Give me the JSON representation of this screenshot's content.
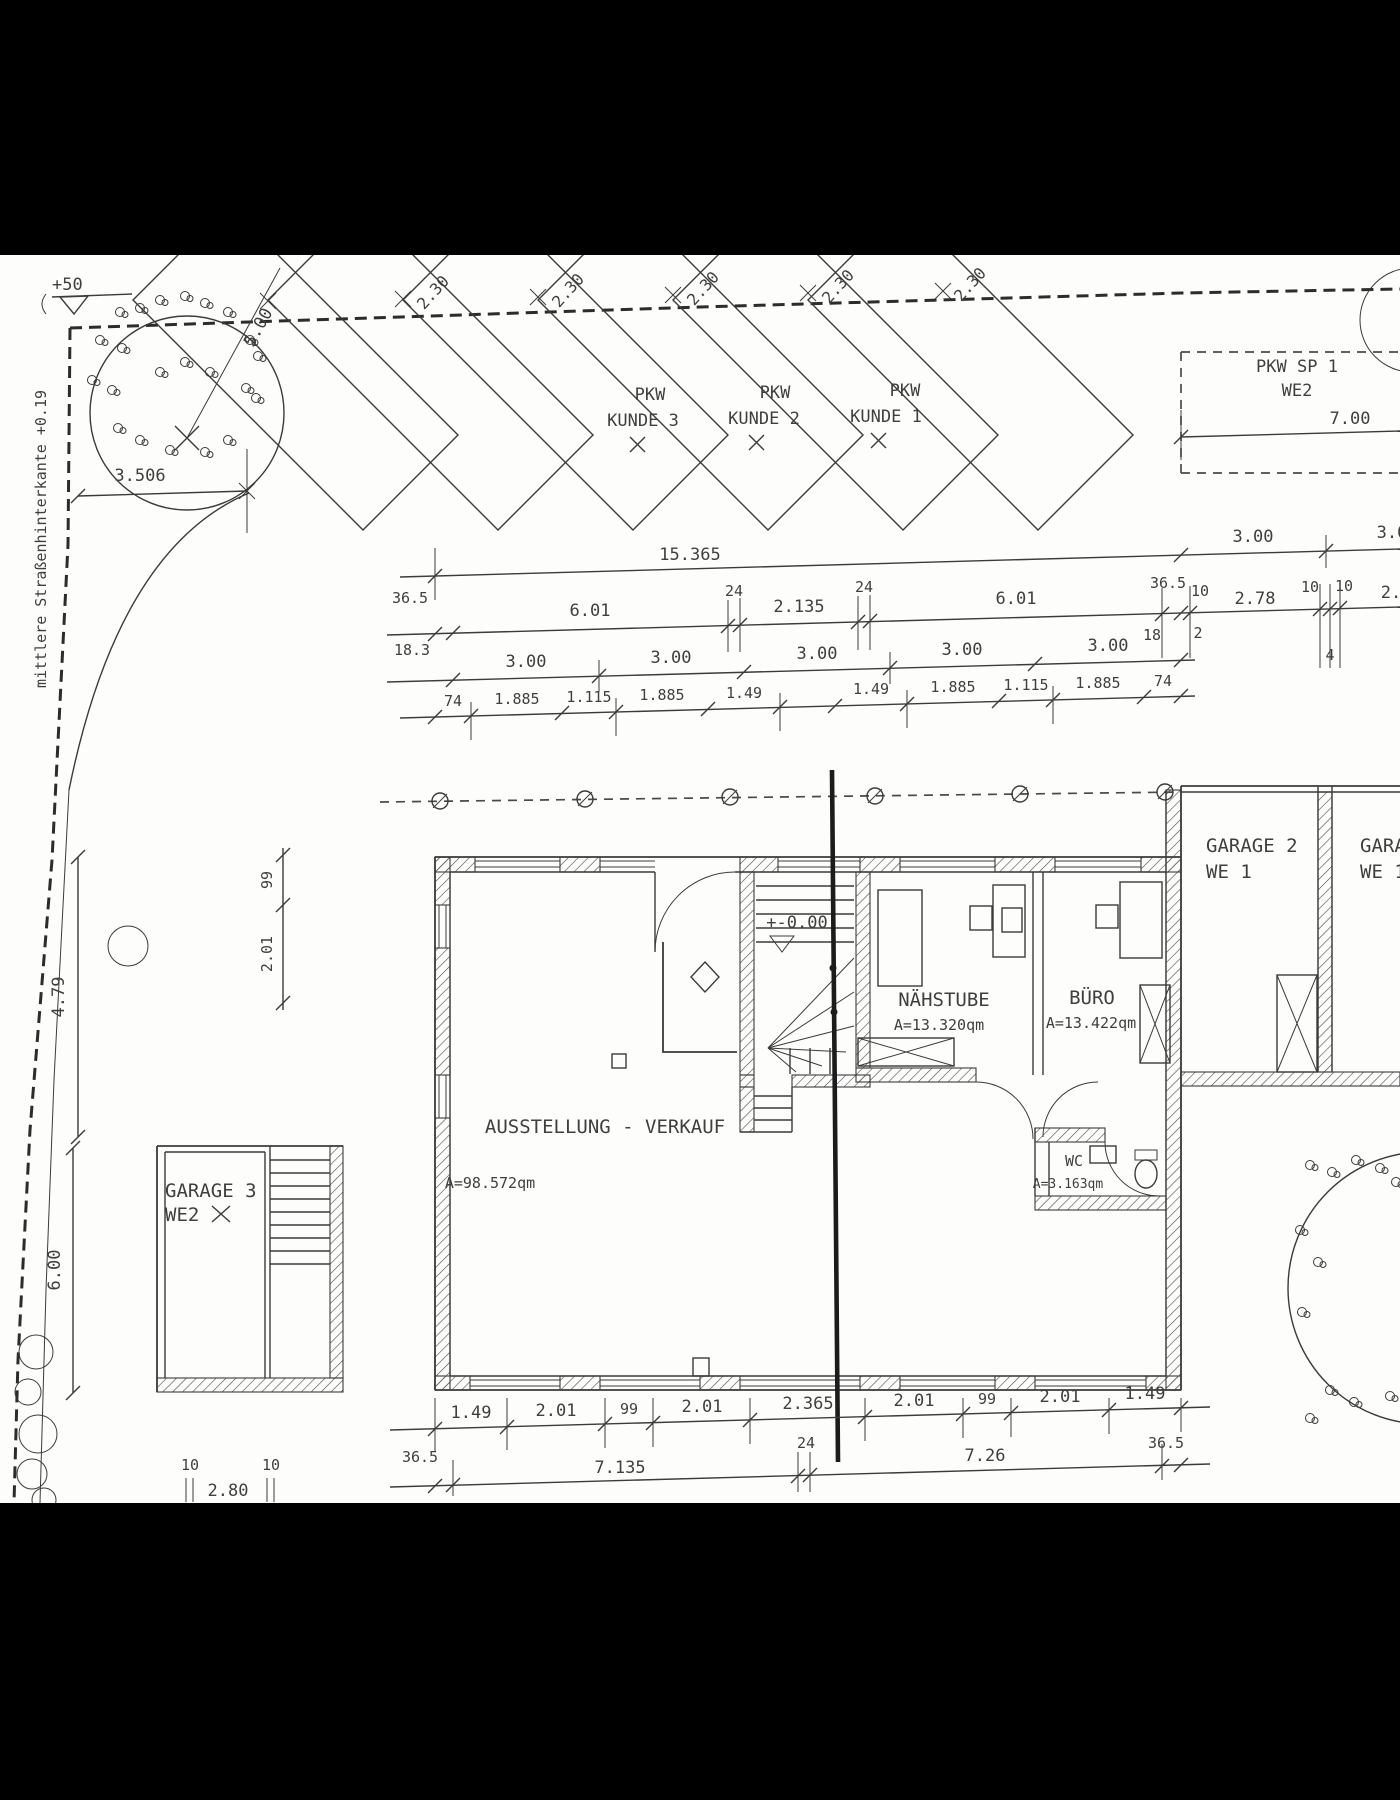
{
  "colors": {
    "paper": "#fdfdfc",
    "ink": "#3b3b3b",
    "bar": "#000000"
  },
  "site": {
    "street_note": "mittlere Straßenhinterkante +0.19",
    "benchmark_label": "+50",
    "tree_radius_dim": "5.00",
    "tree_offset_dim": "3.506",
    "stall_width_dim": "2.30",
    "parking_stalls": [
      {
        "type": "PKW",
        "name": "KUNDE 3"
      },
      {
        "type": "PKW",
        "name": "KUNDE 2"
      },
      {
        "type": "PKW",
        "name": "KUNDE 1"
      }
    ],
    "carport": {
      "name": "PKW SP 1",
      "unit": "WE2",
      "width_dim": "7.00"
    }
  },
  "building": {
    "level_label": "+-0.00",
    "rooms": [
      {
        "name": "AUSSTELLUNG - VERKAUF",
        "area": "A=98.572qm"
      },
      {
        "name": "NÄHSTUBE",
        "area": "A=13.320qm"
      },
      {
        "name": "BÜRO",
        "area": "A=13.422qm"
      },
      {
        "name": "WC",
        "area": "A=3.163qm"
      }
    ]
  },
  "garages": [
    {
      "name": "GARAGE 3",
      "unit": "WE2"
    },
    {
      "name": "GARAGE 2",
      "unit": "WE 1"
    },
    {
      "name": "GARA",
      "unit": "WE 1"
    }
  ],
  "dims": {
    "row_a": [
      "15.365",
      "3.00",
      "3.0"
    ],
    "row_b_top": [
      "36.5",
      "6.01",
      "24",
      "2.135",
      "24",
      "6.01",
      "36.5",
      "10",
      "2.78",
      "10",
      "10",
      "2."
    ],
    "row_b_bottom": [
      "18.3",
      "18",
      "2",
      "4"
    ],
    "row_c": [
      "3.00",
      "3.00",
      "3.00",
      "3.00",
      "3.00"
    ],
    "row_d": [
      "74",
      "1.885",
      "1.115",
      "1.885",
      "1.49",
      "1.135",
      "1.49",
      "1.885",
      "1.115",
      "1.885",
      "74"
    ],
    "left_vertical": [
      "99",
      "2.01",
      "4.79",
      "6.00"
    ],
    "row_e": [
      "1.49",
      "2.01",
      "99",
      "2.01",
      "2.365",
      "2.01",
      "99",
      "2.01",
      "1.49",
      "36.5"
    ],
    "row_f": [
      "36.5",
      "7.135",
      "24",
      "7.26"
    ],
    "garage3_bottom": [
      "10",
      "2.80",
      "10"
    ]
  }
}
